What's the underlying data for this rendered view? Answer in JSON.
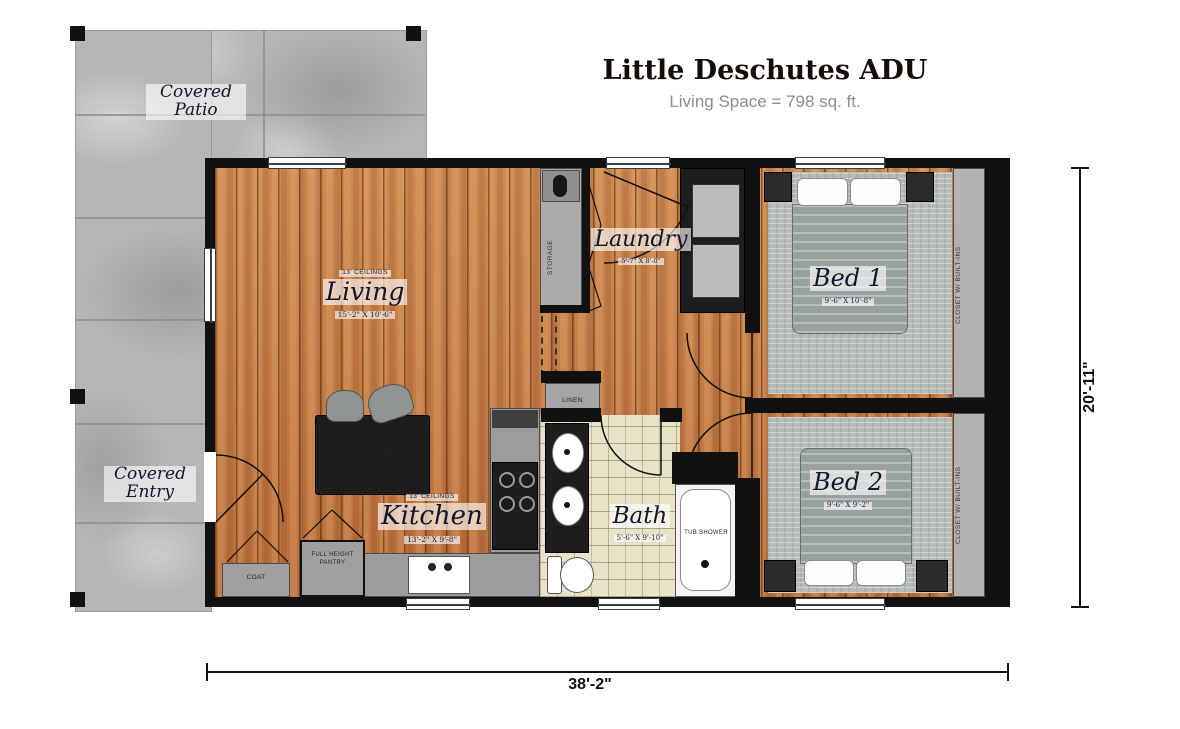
{
  "header": {
    "title": "Little Deschutes ADU",
    "subtitle": "Living Space = 798 sq. ft."
  },
  "rooms": {
    "living": {
      "ceiling": "13' CEILINGS",
      "name": "Living",
      "dims": "15'-2\" X 10'-6\""
    },
    "kitchen": {
      "ceiling": "13' CEILINGS",
      "name": "Kitchen",
      "dims": "13'-2\" X 9'-8\""
    },
    "laundry": {
      "name": "Laundry",
      "dims": "5'-7\" X 8'-0\""
    },
    "bath": {
      "name": "Bath",
      "dims": "5'-6\" X 9'-10\""
    },
    "bed1": {
      "name": "Bed 1",
      "dims": "9'-6\" X 10'-8\""
    },
    "bed2": {
      "name": "Bed 2",
      "dims": "9'-6\" X 9'-2\""
    },
    "covered_patio": {
      "name": "Covered Patio"
    },
    "covered_entry": {
      "name": "Covered Entry"
    }
  },
  "features": {
    "storage": "STORAGE",
    "linen": "LINEN",
    "coat": "COAT",
    "pantry": "FULL HEIGHT PANTRY",
    "island": "30\" ISLAND",
    "tub_shower": "TUB SHOWER",
    "closet_bed1": "CLOSET W/ BUILT-INS",
    "closet_bed2": "CLOSET W/ BUILT-INS"
  },
  "dimensions": {
    "overall_width": "38'-2\"",
    "overall_height": "20'-11\""
  },
  "colors": {
    "wood_floor": "#c27a45",
    "carpet": "#b7bbb7",
    "tile": "#e7e3c9",
    "concrete": "#b6b6b6",
    "wall": "#111111",
    "cabinet_grey": "#9c9c9c",
    "dark_furniture": "#1d1d1d",
    "subtitle_grey": "#8d8d8d"
  }
}
